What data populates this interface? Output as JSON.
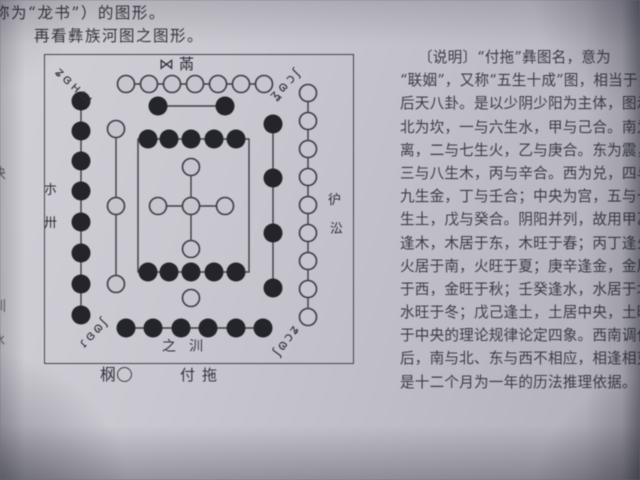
{
  "intro": {
    "line1": "称为“龙书”）的图形。",
    "line2": "再看彝族河图之图形。"
  },
  "edge_bleed": [
    "诀",
    "训",
    "冰"
  ],
  "figure": {
    "yi_labels": {
      "top_center": "⋈㒼",
      "corner_top_left": "ʑɞʜɰ",
      "corner_top_right": "ʓɷɔʃ",
      "corner_bottom_left": "ɾɞɷʃ",
      "corner_bottom_right": "ʃɷɔʑ",
      "side_left_top": "朩",
      "side_left_bottom": "卅",
      "side_right_top": "㣗",
      "side_right_bottom": "㳂",
      "bottom_center": "之汌"
    },
    "caption": {
      "yi_glyph": "㭎",
      "legend_circle": "○",
      "title": "付拖"
    },
    "meaning": {
      "name": "付拖 (五生十成图)",
      "south_top": "7 hollow + 2 filled",
      "north_bottom": "1 hollow + 6 filled",
      "east_left": "8 filled + 3 hollow",
      "west_right": "9 hollow + 4 filled",
      "center": "5 hollow cross + 10 filled square"
    },
    "elements": {
      "lines": [
        [
          81,
          29,
          219,
          29
        ],
        [
          113,
          51,
          180,
          51
        ],
        [
          36,
          46,
          36,
          260
        ],
        [
          71,
          74,
          71,
          229
        ],
        [
          263,
          38,
          263,
          262
        ],
        [
          228,
          69,
          228,
          233
        ],
        [
          146,
          112,
          146,
          194
        ],
        [
          113,
          151,
          180,
          151
        ],
        [
          81,
          273,
          218,
          273
        ]
      ],
      "rects": [
        [
          93,
          84,
          111,
          133
        ]
      ],
      "hollow": [
        [
          81,
          29
        ],
        [
          104,
          29
        ],
        [
          127,
          29
        ],
        [
          150,
          29
        ],
        [
          173,
          29
        ],
        [
          196,
          29
        ],
        [
          219,
          29
        ],
        [
          71,
          74
        ],
        [
          71,
          151
        ],
        [
          71,
          229
        ],
        [
          263,
          38
        ],
        [
          263,
          66
        ],
        [
          263,
          94
        ],
        [
          263,
          122
        ],
        [
          263,
          150
        ],
        [
          263,
          178
        ],
        [
          263,
          206
        ],
        [
          263,
          234
        ],
        [
          263,
          262
        ],
        [
          146,
          112
        ],
        [
          113,
          151
        ],
        [
          146,
          151
        ],
        [
          180,
          151
        ],
        [
          146,
          194
        ],
        [
          146,
          243
        ]
      ],
      "filled": [
        [
          113,
          51
        ],
        [
          180,
          51
        ],
        [
          36,
          46
        ],
        [
          36,
          76
        ],
        [
          36,
          106
        ],
        [
          36,
          136
        ],
        [
          36,
          167
        ],
        [
          36,
          198
        ],
        [
          36,
          229
        ],
        [
          36,
          260
        ],
        [
          228,
          69
        ],
        [
          228,
          123
        ],
        [
          228,
          178
        ],
        [
          228,
          233
        ],
        [
          103,
          84
        ],
        [
          124,
          84
        ],
        [
          146,
          84
        ],
        [
          169,
          84
        ],
        [
          191,
          84
        ],
        [
          103,
          217
        ],
        [
          124,
          217
        ],
        [
          146,
          217
        ],
        [
          169,
          217
        ],
        [
          191,
          217
        ],
        [
          81,
          273
        ],
        [
          108,
          273
        ],
        [
          136,
          273
        ],
        [
          163,
          273
        ],
        [
          191,
          273
        ],
        [
          218,
          273
        ]
      ]
    }
  },
  "description": {
    "lines": [
      "〔说明〕“付拖”彝图名，意为",
      "“联姻”，又称“五生十成”图，相当于",
      "后天八卦。是以少阴少阳为主体，图示",
      "北为坎，一与六生水，甲与己合。南为",
      "离，二与七生火，乙与庚合。东为震，",
      "三与八生木，丙与辛合。西为兑，四与",
      "九生金，丁与壬合；中央为宫，五与十",
      "生土，戊与癸合。阴阳并列，故用甲乙",
      "逢木，木居于东，木旺于春；丙丁逢火，",
      "火居于南，火旺于夏；庚辛逢金，金居",
      "于西，金旺于秋；壬癸逢水，水居于北，",
      "水旺于冬；戊己逢土，土居中央，土旺",
      "于中央的理论规律论定四象。西南调位",
      "后，南与北、东与西不相应，相逢相克，",
      "是十二个月为一年的历法推理依据。"
    ]
  }
}
